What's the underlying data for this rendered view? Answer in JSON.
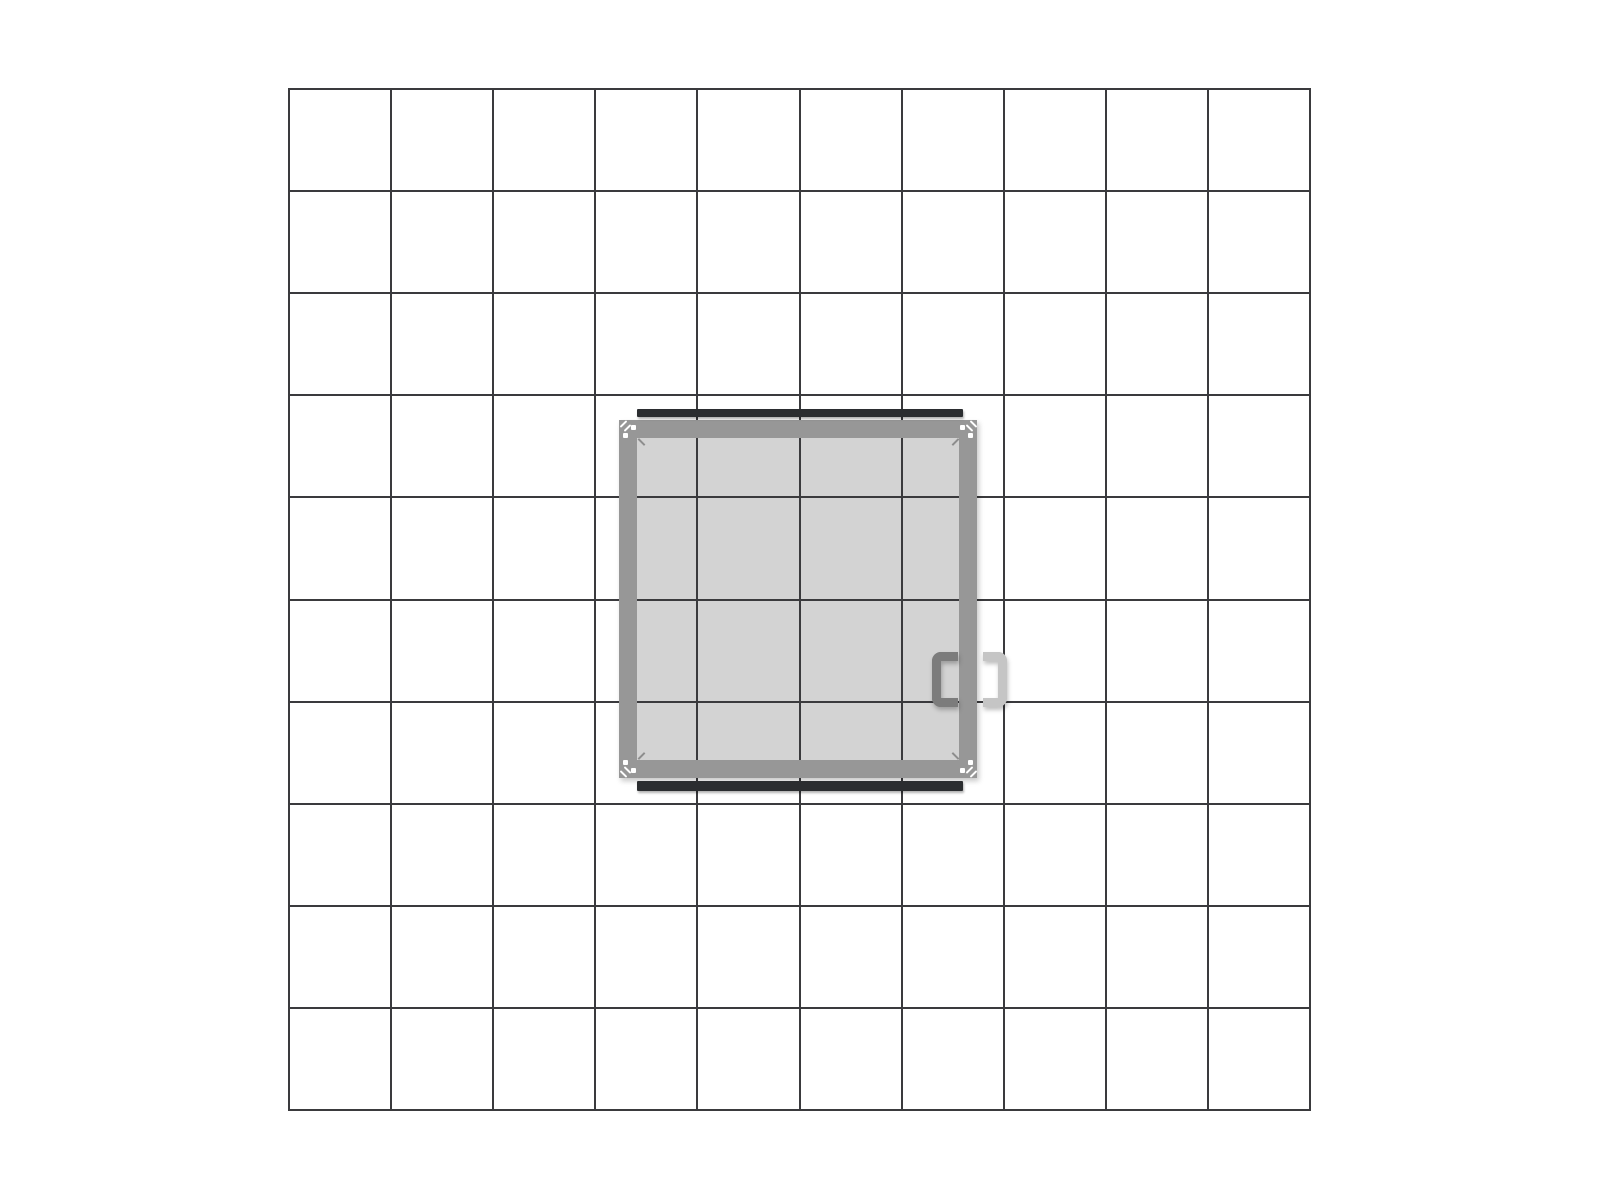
{
  "scene": {
    "name": "roof-hatch-plan-drawing",
    "background": "#ffffff",
    "width": 1600,
    "height": 1200
  },
  "grid": {
    "origin_x": 289,
    "origin_y": 89,
    "columns": 10,
    "rows": 10,
    "cell_size": 102.1,
    "line_width": 2,
    "line_color": "#3a3a3d"
  },
  "hatch": {
    "frame": {
      "x": 619,
      "y": 420,
      "size": 358,
      "thickness": 18,
      "color": "#979797",
      "shadow": "2px 3px 5px rgba(0,0,0,0.22)"
    },
    "interior": {
      "x": 637,
      "y": 438,
      "size": 322,
      "color": "#d3d3d3"
    },
    "bars": {
      "color": "#2b2d30",
      "shadow": "1px 2px 2px rgba(0,0,0,0.3)",
      "top": {
        "x": 637,
        "y": 409,
        "width": 326,
        "height": 8
      },
      "bottom": {
        "x": 637,
        "y": 781,
        "width": 326,
        "height": 10
      }
    },
    "bolts": {
      "color": "#ffffff",
      "size": 5,
      "positions": [
        [
          631,
          425
        ],
        [
          623,
          433
        ],
        [
          960,
          425
        ],
        [
          968,
          433
        ],
        [
          631,
          768
        ],
        [
          623,
          760
        ],
        [
          960,
          768
        ],
        [
          968,
          760
        ]
      ]
    },
    "corner_slashes": {
      "color": "#ffffff",
      "length": 9,
      "width": 2,
      "strokes": [
        [
          623,
          424,
          -45
        ],
        [
          627,
          428,
          -45
        ],
        [
          973,
          424,
          45
        ],
        [
          969,
          428,
          45
        ],
        [
          623,
          774,
          45
        ],
        [
          627,
          770,
          45
        ],
        [
          973,
          774,
          -45
        ],
        [
          969,
          770,
          -45
        ]
      ]
    },
    "miters": {
      "color": "#8d8d8d",
      "length": 9,
      "width": 2,
      "strokes": [
        [
          641,
          442,
          45
        ],
        [
          955,
          442,
          -45
        ],
        [
          641,
          756,
          -45
        ],
        [
          955,
          756,
          45
        ]
      ]
    },
    "handles": {
      "shadow": "drop-shadow(1px 3px 2px rgba(0,0,0,0.25))",
      "inner": {
        "x": 932,
        "y": 652,
        "width": 26,
        "height": 55,
        "stroke": 9,
        "radius": 9,
        "color": "#7c7c7c",
        "open": "right"
      },
      "outer": {
        "x": 983,
        "y": 652,
        "width": 24,
        "height": 55,
        "stroke": 9,
        "radius": 9,
        "color": "#c5c5c5",
        "open": "left"
      }
    }
  }
}
